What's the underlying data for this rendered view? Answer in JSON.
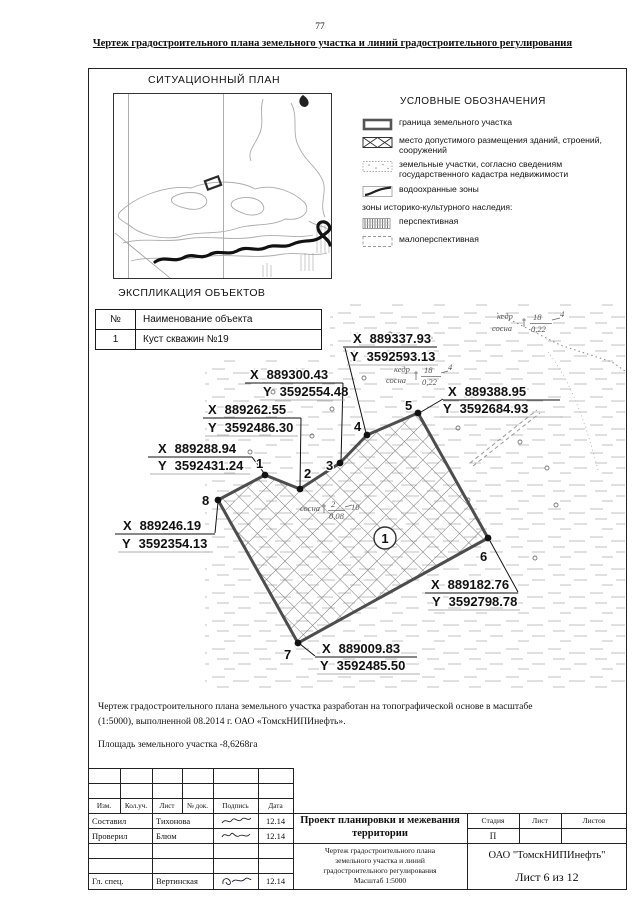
{
  "page": {
    "number": "77",
    "title": "Чертеж градостроительного плана земельного участка и линий градостроительного регулирования"
  },
  "situational_plan": {
    "title": "СИТУАЦИОННЫЙ ПЛАН"
  },
  "legend": {
    "title": "УСЛОВНЫЕ ОБОЗНАЧЕНИЯ",
    "items": [
      {
        "label": "граница земельного участка"
      },
      {
        "label": "место допустимого размещения зданий, строений, сооружений"
      },
      {
        "label": "земельные участки, согласно сведениям государственного кадастра недвижимости"
      },
      {
        "label": "водоохранные зоны"
      }
    ],
    "subheading": "зоны историко-культурного наследия:",
    "heritage_items": [
      {
        "label": "перспективная"
      },
      {
        "label": "малоперспективная"
      }
    ]
  },
  "explication": {
    "title": "ЭКСПЛИКАЦИЯ ОБЪЕКТОВ",
    "columns": [
      "№",
      "Наименование объекта"
    ],
    "rows": [
      {
        "num": "1",
        "name": "Куст скважин №19"
      }
    ]
  },
  "plot": {
    "axis_x": "X",
    "axis_y": "Y",
    "area_label": "1",
    "points": [
      {
        "n": "1",
        "x": "889288.94",
        "y": "3592431.24"
      },
      {
        "n": "2",
        "x": "889262.55",
        "y": "3592486.30"
      },
      {
        "n": "3",
        "x": "889300.43",
        "y": "3592554.48"
      },
      {
        "n": "4",
        "x": "889337.93",
        "y": "3592593.13"
      },
      {
        "n": "5",
        "x": "889388.95",
        "y": "3592684.93"
      },
      {
        "n": "6",
        "x": "889182.76",
        "y": "3592798.78"
      },
      {
        "n": "7",
        "x": "889009.83",
        "y": "3592485.50"
      },
      {
        "n": "8",
        "x": "889246.19",
        "y": "3592354.13"
      }
    ],
    "tree_labels": [
      {
        "s1": "кедр",
        "s2": "сосна",
        "num": "18",
        "den": "0,22",
        "cnt": "4"
      },
      {
        "s1": "кедр",
        "s2": "сосна",
        "num": "18",
        "den": "0,22",
        "cnt": "4"
      },
      {
        "s1": "сосна",
        "num": "2",
        "den": "0,08",
        "cnt": "10"
      }
    ]
  },
  "notes": {
    "p1": "Чертеж градостроительного плана земельного участка разработан на топографической основе  в масштабе (1:5000), выполненной  08.2014 г. ОАО «ТомскНИПИнефть».",
    "p2": "Площадь земельного участка -8,6268га"
  },
  "titleblock": {
    "header": [
      "Изм.",
      "Кол.уч.",
      "Лист",
      "№ док.",
      "Подпись",
      "Дата"
    ],
    "rows": [
      {
        "role": "Составил",
        "name": "Тихонова",
        "date": "12.14"
      },
      {
        "role": "Проверил",
        "name": "Блюм",
        "date": "12.14"
      },
      {
        "role": "Гл. спец.",
        "name": "Вертинская",
        "date": "12.14"
      }
    ],
    "project": "Проект планировки и межевания территории",
    "stage_label": "Стадия",
    "sheet_label": "Лист",
    "sheets_label": "Листов",
    "stage_value": "П",
    "doc_lines": [
      "Чертеж градостроительного плана",
      "земельного участка и линий",
      "градостроительного регулирования",
      "Масштаб 1:5000"
    ],
    "company": "ОАО \"ТомскНИПИнефть\"",
    "sheet_info": "Лист 6 из 12"
  }
}
